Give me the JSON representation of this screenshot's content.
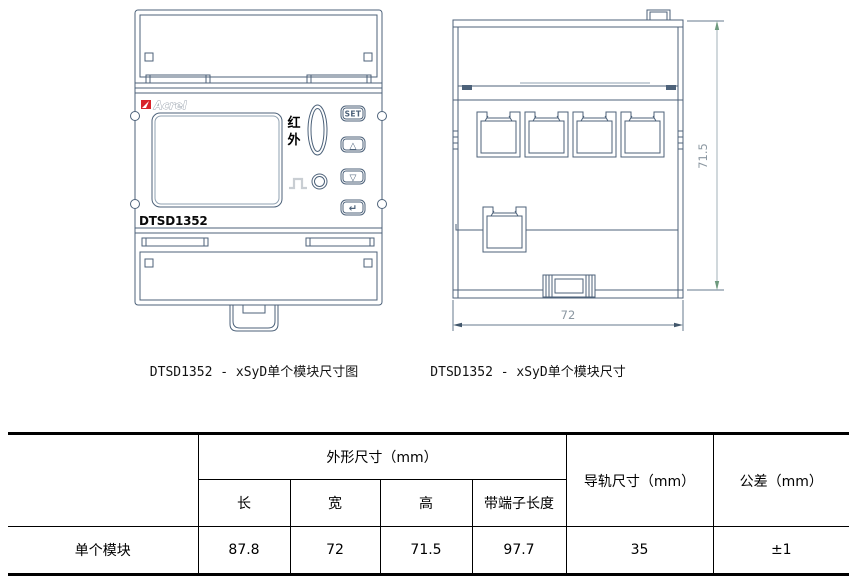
{
  "colors": {
    "drawing_line": "#4d627a",
    "dimension_line": "#64788c",
    "dimension_line_light": "#bdc7ce",
    "dimension_text": "#8b97a1",
    "arrow_green": "#6e9a7e",
    "arrow_dark": "#41566b",
    "brand_red": "#d8232a",
    "pulse_gray": "#c9ced3",
    "table_text": "#000000"
  },
  "front_view": {
    "brand": "Acrel",
    "ir_chars": [
      "红",
      "外"
    ],
    "model": "DTSD1352",
    "buttons": {
      "set": "SET",
      "up": "△",
      "down": "▽",
      "enter": "↵"
    }
  },
  "side_view": {
    "dim_height_mm": "71.5",
    "dim_width_mm": "72"
  },
  "captions": {
    "front": "DTSD1352 - xSyD单个模块尺寸图",
    "side": "DTSD1352 - xSyD单个模块尺寸"
  },
  "table": {
    "col_headers": {
      "outline": "外形尺寸（mm）",
      "length": "长",
      "width": "宽",
      "height": "高",
      "terminal_length": "带端子长度",
      "rail": "导轨尺寸（mm）",
      "tolerance": "公差（mm）"
    },
    "rows": [
      {
        "label": "单个模块",
        "length": "87.8",
        "width": "72",
        "height": "71.5",
        "terminal_length": "97.7",
        "rail": "35",
        "tolerance": "±1"
      }
    ]
  }
}
